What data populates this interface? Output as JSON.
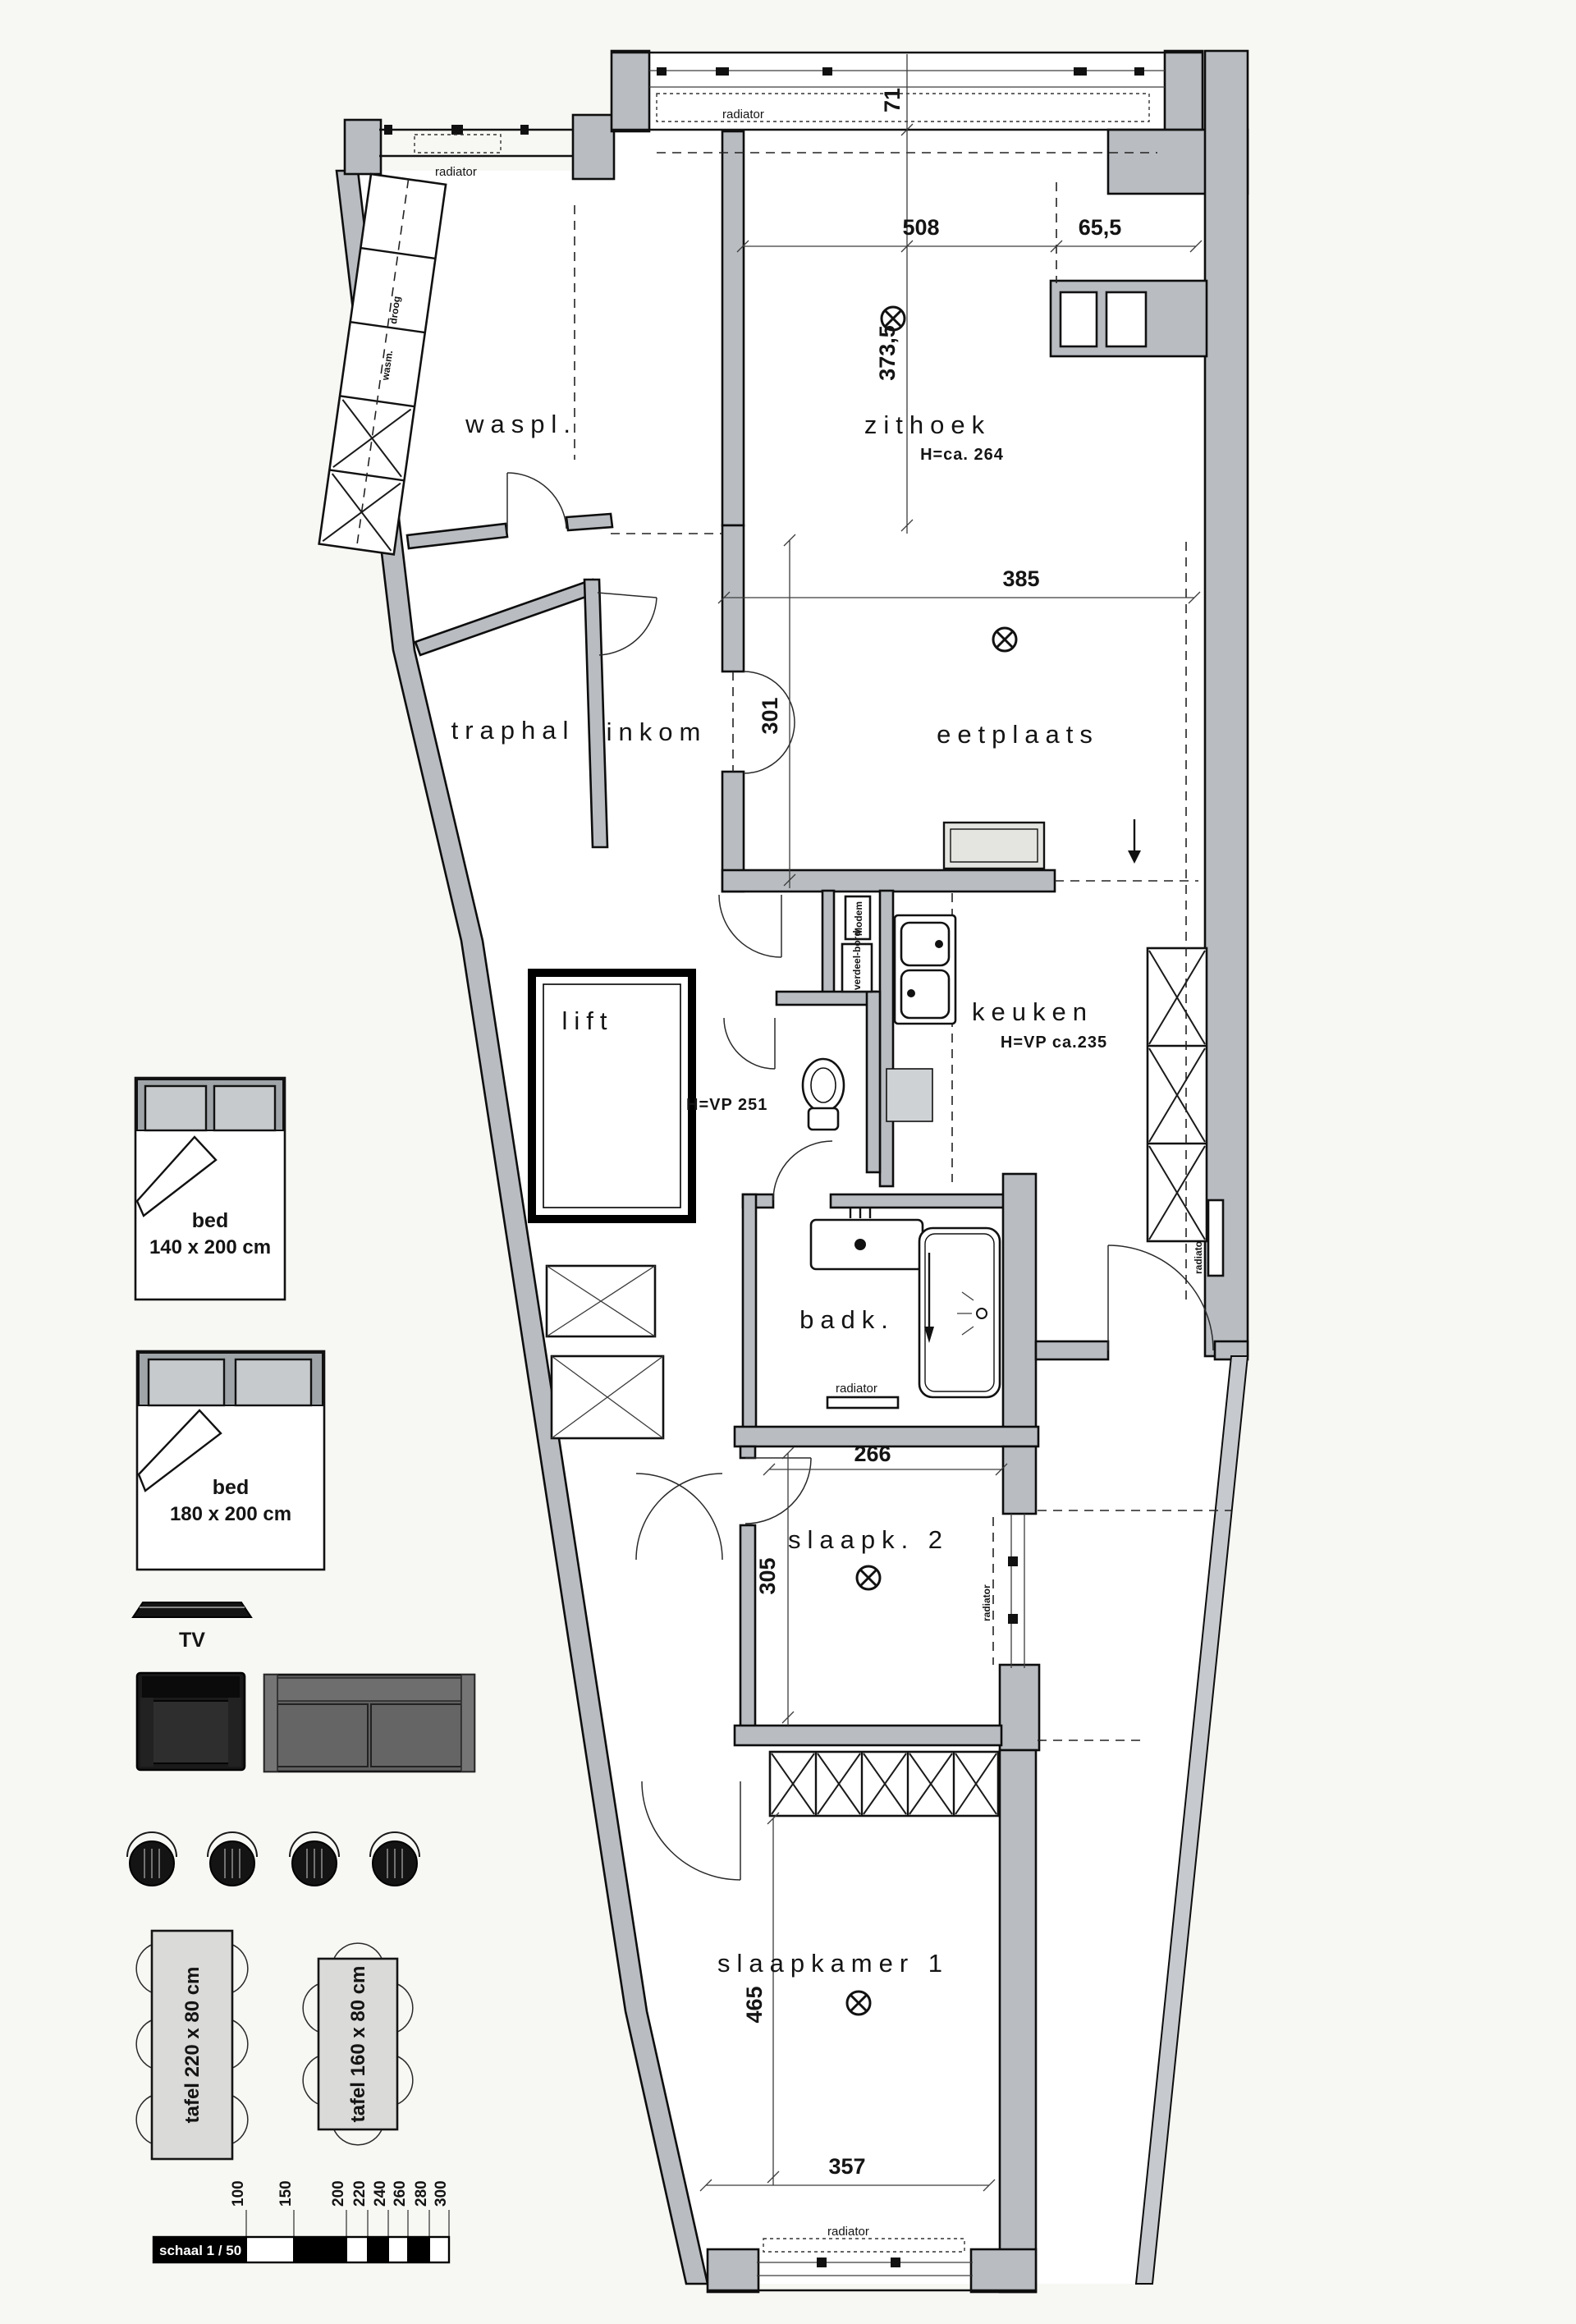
{
  "plan": {
    "rooms": {
      "waspl": {
        "label": "waspl."
      },
      "zithoek": {
        "label": "zithoek",
        "height_note": "H=ca. 264"
      },
      "traphal": {
        "label": "traphal"
      },
      "inkom": {
        "label": "inkom"
      },
      "eetplaats": {
        "label": "eetplaats"
      },
      "lift": {
        "label": "lift"
      },
      "keuken": {
        "label": "keuken",
        "height_note": "H=VP ca.235"
      },
      "badk": {
        "label": "badk."
      },
      "slaapk2": {
        "label": "slaapk. 2"
      },
      "slaapkamer1": {
        "label": "slaapkamer 1"
      },
      "hal_note": "H=VP 251"
    },
    "dimensions": {
      "top_width": "508",
      "top_niche": "65,5",
      "zithoek_depth": "373,5",
      "bay_depth": "71",
      "eetplaats_width": "385",
      "inkom_depth": "301",
      "slaapk2_width": "266",
      "slaapk2_depth": "305",
      "slaapkamer1_depth": "465",
      "slaapkamer1_width": "357"
    },
    "fixture_labels": {
      "radiator": "radiator",
      "modem": "Modem",
      "verdeelbord": "verdeel-bord",
      "droog": "droog",
      "wasm": "wasm."
    }
  },
  "legend": {
    "bed140": {
      "label": "bed",
      "size": "140 x 200 cm"
    },
    "bed180": {
      "label": "bed",
      "size": "180 x 200 cm"
    },
    "tv": "TV",
    "tafel220": "tafel 220 x 80 cm",
    "tafel160": "tafel 160 x 80 cm"
  },
  "scalebar": {
    "label": "schaal 1 / 50",
    "ticks": [
      "100",
      "150",
      "200",
      "220",
      "240",
      "260",
      "280",
      "300"
    ]
  },
  "colors": {
    "paper": "#f7f7f4",
    "wall_fill": "#b9bdc2",
    "line": "#111111",
    "furniture_dark": "#1a1a1a",
    "furniture_sofa": "#606060",
    "table_fill": "#dadad8"
  }
}
